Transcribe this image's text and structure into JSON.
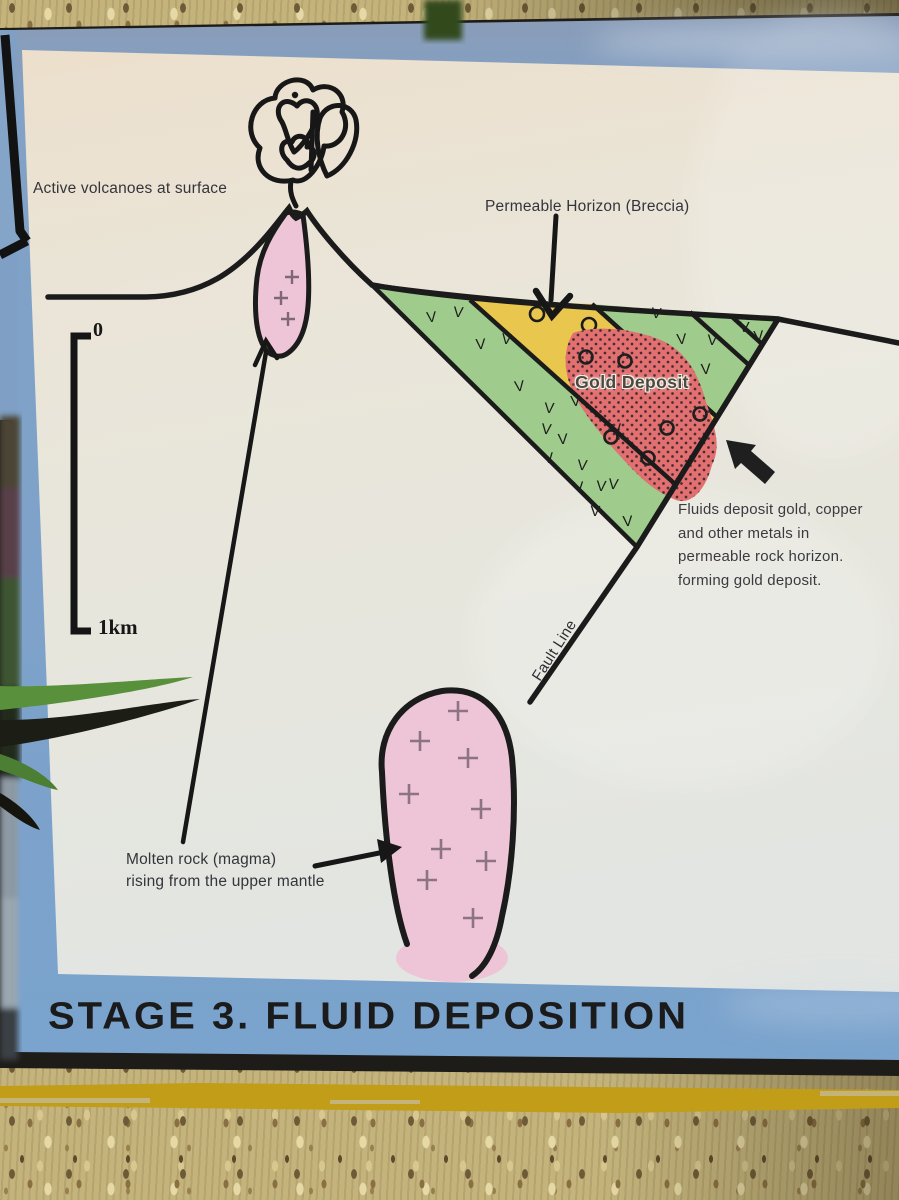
{
  "sign": {
    "title": "STAGE 3. FLUID DEPOSITION",
    "panel": {
      "label_active_volcanoes": "Active volcanoes at surface",
      "label_permeable_horizon": "Permeable Horizon (Breccia)",
      "label_gold_deposit": "Gold Deposit",
      "label_fault_line": "Fault Line",
      "fluids_note_lines": [
        "Fluids deposit gold, copper",
        "and other metals in",
        "permeable rock horizon.",
        "forming gold deposit."
      ],
      "magma_note_lines": [
        "Molten rock (magma)",
        "rising from the upper mantle"
      ],
      "scale": {
        "top": "0",
        "bottom": "1km"
      }
    },
    "symbols": {
      "volcanic_rock": "V",
      "breccia_clast": "o",
      "magma_plus": "+"
    },
    "colors": {
      "border_blue": "#7fa2c9",
      "panel_cream": "#e9e4d7",
      "volcanic_green": "#9fcc8c",
      "breccia_yellow": "#e9c74e",
      "gold_deposit_red": "#e27070",
      "magma_pink": "#eec5d7",
      "line_black": "#1c1c1c",
      "stripe_mustard": "#c19d18",
      "background_tan": "#c4b47c"
    }
  }
}
